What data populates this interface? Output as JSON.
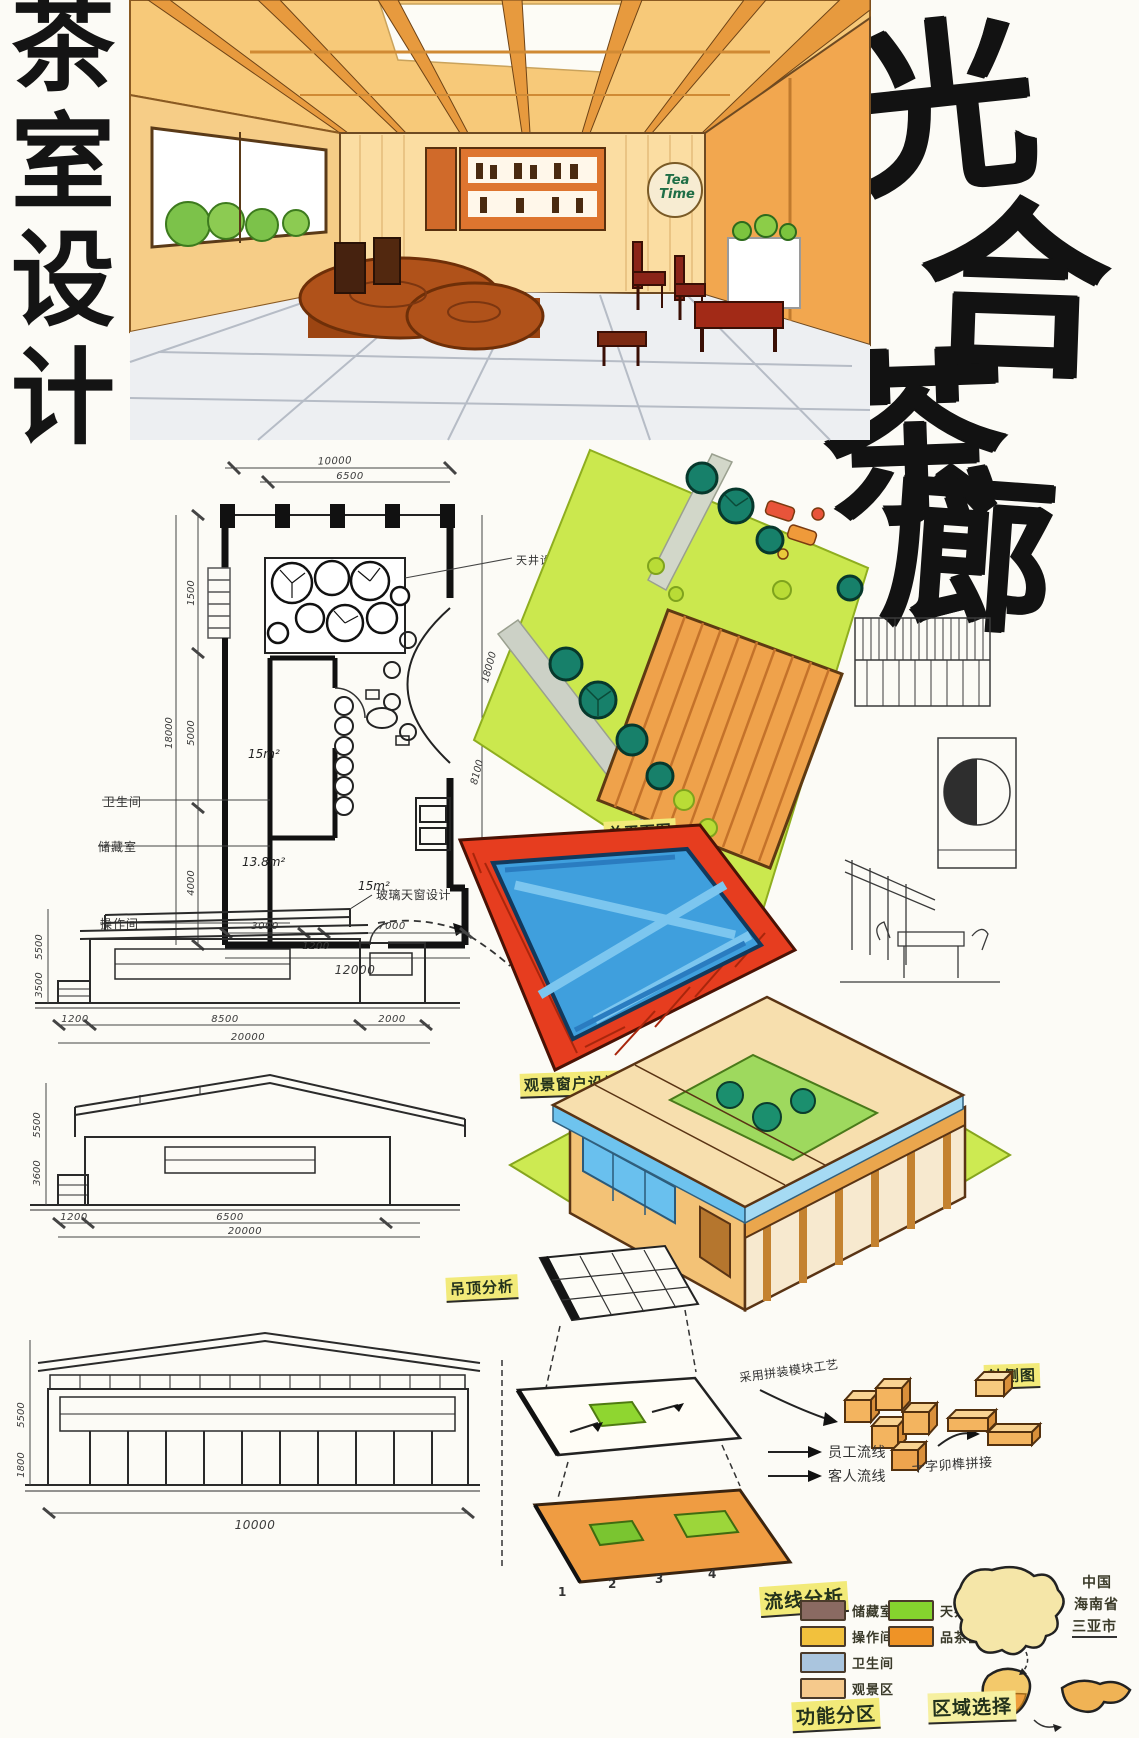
{
  "titles": {
    "side_vertical": [
      "茶",
      "室",
      "设",
      "计"
    ],
    "main_calligraphy": [
      "光",
      "合",
      "茶",
      "廊"
    ]
  },
  "perspective": {
    "sign_line1": "Tea",
    "sign_line2": "Time"
  },
  "floor_plan": {
    "dim_top_outer": "10000",
    "dim_top_inner": "6500",
    "dim_left_outer": "18000",
    "dims_left": [
      "1500",
      "5000",
      "4000"
    ],
    "dims_right": [
      "18000",
      "8100"
    ],
    "dims_bottom": [
      "3000",
      "1200",
      "7000"
    ],
    "dim_bottom_total": "12000",
    "room_area_1": "15m²",
    "room_area_2": "13.8m²",
    "room_area_3": "15m²",
    "label_courtyard": "天井设计",
    "label_bathroom": "卫生间",
    "label_storage": "储藏室",
    "label_operation": "操作间"
  },
  "site_plan": {
    "label": "总平面图"
  },
  "window_design": {
    "label": "观景窗户设计"
  },
  "axon": {
    "label": "轴侧图"
  },
  "elevations": {
    "note_skylight": "玻璃天窗设计",
    "e1": {
      "dims_left": [
        "5500",
        "3500"
      ],
      "dims_bottom": [
        "1200",
        "8500",
        "2000"
      ],
      "dim_total": "20000"
    },
    "e2": {
      "dims_left": [
        "5500",
        "3600"
      ],
      "dims_bottom": [
        "1200",
        "6500"
      ],
      "dim_total": "20000"
    },
    "e3": {
      "dims_left": [
        "5500",
        "1800"
      ],
      "dim_total": "10000"
    }
  },
  "exploded": {
    "label": "吊顶分析",
    "note_assembly": "采用拼装模块工艺",
    "note_joint": "十字卯榫拼接",
    "flow_staff": "员工流线",
    "flow_guest": "客人流线",
    "layers": [
      "1",
      "2",
      "3",
      "4"
    ]
  },
  "circulation": {
    "label": "流线分析",
    "legend": [
      {
        "label": "储藏室",
        "color": "#8a6a62"
      },
      {
        "label": "操作间",
        "color": "#f2c13d"
      },
      {
        "label": "卫生间",
        "color": "#aac5de"
      },
      {
        "label": "观景区",
        "color": "#f5c98c"
      },
      {
        "label": "天井",
        "color": "#85d42e"
      },
      {
        "label": "品茶区",
        "color": "#ef9326"
      }
    ]
  },
  "location": {
    "label": "区域选择",
    "lines": [
      "中国",
      "海南省",
      "三亚市"
    ]
  },
  "zoning": {
    "label": "功能分区"
  }
}
